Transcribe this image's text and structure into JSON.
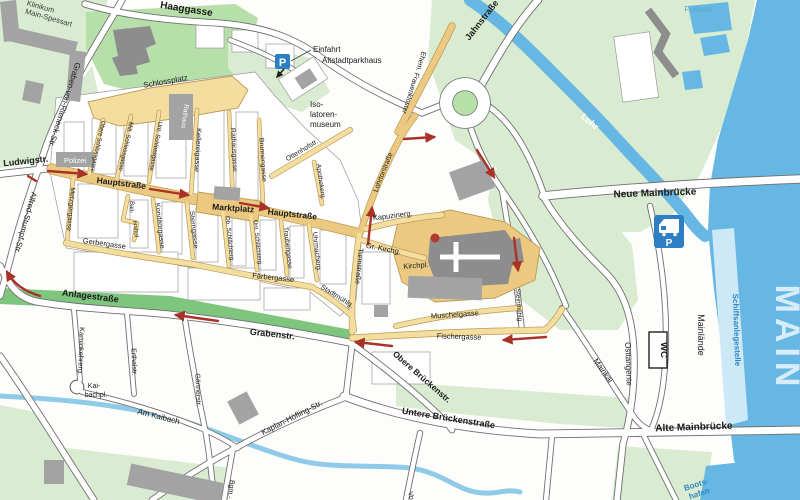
{
  "map": {
    "water": {
      "main": "MAIN",
      "lohr": "Lohr",
      "freibad": "Freibad",
      "schiffsanlegestelle": "Schiffsanlegestelle",
      "bootshafen_line1": "Boots-",
      "bootshafen_line2": "hafen"
    },
    "streets": {
      "haaggasse": "Haaggasse",
      "graben_von_rieneck": "Graben-von-Rieneck-Str.",
      "ludwigstr": "Ludwigstr.",
      "alfred_stumpf": "Alfred-Stumpf-Str.",
      "hauptstrasse_west": "Hauptstraße",
      "hauptstrasse_east": "Hauptstraße",
      "marktplatz": "Marktplatz",
      "schlossplatz": "Schlossplatz",
      "obere_schlossgasse": "Obere Schlossgasse",
      "mitl_schlossgasse": "Mitl. Schlossgasse",
      "unt_schlossgasse": "Unt. Schlossgasse",
      "kellereigasse": "Kellereigasse",
      "rathausgasse": "Rathausgasse",
      "brunnengasse": "Brunnengasse",
      "apothekerg": "Apothekerg.",
      "metzgergasse": "Metzgergasse",
      "baltershof_line1": "Balt-",
      "baltershof_line2": "ershof",
      "konditorgasse": "Konditorgasse",
      "sterngasse": "Sterngasse",
      "ob_schlaechterg": "Ob. Schlächterg.",
      "unt_schlaechterg": "Unt. Schlächterg.",
      "traubengasse": "Traubengasse",
      "uhrmacherg": "Uhrmacherg.",
      "gerbergasse": "Gerbergasse",
      "faerbergasse": "Färbergasse",
      "stadtmuehlg": "Stadtmühlg.",
      "turmstrasse": "Turmstraße",
      "ottenhofstr": "Ottenhofstr.",
      "lohrtorstrasse": "Lohrtorstraße",
      "kapuzinerg": "Kapuzinerg.",
      "gr_kirchg": "Gr. Kirchg.",
      "kirchpl": "Kirchpl.",
      "muschelgasse": "Muschelgasse",
      "fischergasse": "Fischergasse",
      "steinmuehlg": "Steinmühlg.",
      "ehem_frauenkloster": "Ehem. Frauenkloster",
      "jahnstrasse": "Jahnstraße",
      "neue_mainbruecke": "Neue Mainbrücke",
      "alte_mainbruecke": "Alte Mainbrücke",
      "osttangente": "Osttangente",
      "mainlaende": "Mainlände",
      "mainkai": "Mainkai",
      "anlagestrasse": "Anlagestraße",
      "grabenstr": "Grabenstr.",
      "kaminkehrerg": "Kaminkehrerg.",
      "erthalstr": "Erthalstr.",
      "gaertnerstr": "Gärtnerstr.",
      "am_kaibach": "Am Kaibach",
      "kaibachpl_line1": "Kai-",
      "kaibachpl_line2": "bachpl.",
      "kaplan_hoefling": "Kaplan-Höfling-Str.",
      "obere_brueckenstr": "Obere Brückenstr.",
      "untere_brueckenstrasse": "Untere Brückenstraße",
      "bgm_partial": "Bgm.-",
      "vorstadt_partial": "Vo"
    },
    "places": {
      "klinikum_line1": "Klinikum",
      "klinikum_line2": "Main-Spessart",
      "polizei": "Polizei",
      "rathaus": "Rathaus",
      "einfahrt_line1": "Einfahrt",
      "einfahrt_line2": "Altstadtparkhaus",
      "isolatoren_line1": "Iso-",
      "isolatoren_line2": "latoren-",
      "isolatoren_line3": "museum",
      "wc": "WC",
      "parking_p": "P",
      "camper_p": "P"
    },
    "colors": {
      "water": "#66b7e3",
      "water_light": "#cde9f8",
      "green_light": "#d9ecd1",
      "green_mid": "#b7dfa9",
      "green_dark": "#7ec57e",
      "street_yellow": "#f3dd9f",
      "street_trunk": "#ecc981",
      "route_red": "#a93228",
      "sign_blue": "#2b7fc2",
      "building_gray": "#a3a3a3"
    }
  }
}
